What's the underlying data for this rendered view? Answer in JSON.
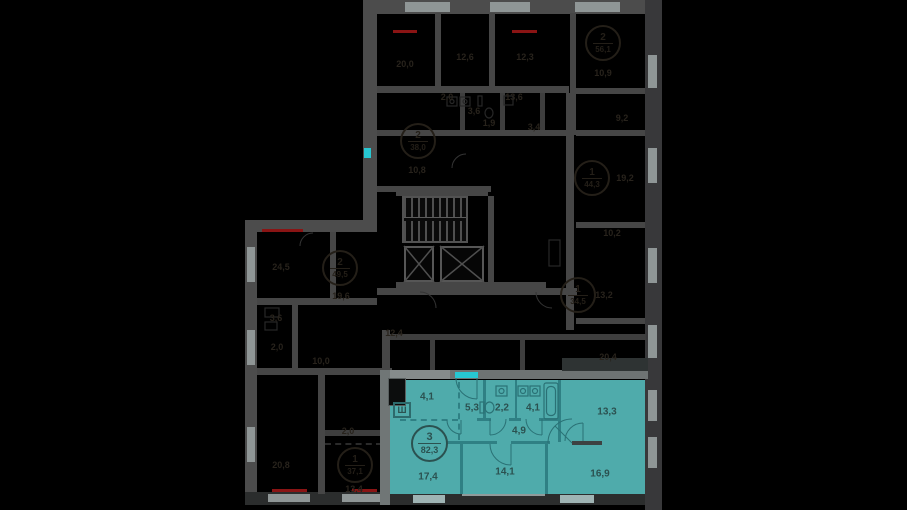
{
  "plan": {
    "highlighted_apartment": {
      "badge": {
        "rooms": "3",
        "area": "82,3"
      },
      "wardrobe_label": "Ш",
      "room_areas": [
        {
          "t": "4,1",
          "x": 427,
          "y": 397
        },
        {
          "t": "5,3",
          "x": 472,
          "y": 408
        },
        {
          "t": "2,2",
          "x": 502,
          "y": 408
        },
        {
          "t": "4,1",
          "x": 533,
          "y": 408
        },
        {
          "t": "13,3",
          "x": 607,
          "y": 412
        },
        {
          "t": "4,9",
          "x": 519,
          "y": 431
        },
        {
          "t": "17,4",
          "x": 428,
          "y": 477
        },
        {
          "t": "14,1",
          "x": 505,
          "y": 472
        },
        {
          "t": "16,9",
          "x": 600,
          "y": 474
        }
      ]
    },
    "dimmed": {
      "area_labels": [
        {
          "t": "20,0",
          "x": 405,
          "y": 64
        },
        {
          "t": "12,6",
          "x": 465,
          "y": 57
        },
        {
          "t": "12,3",
          "x": 525,
          "y": 57
        },
        {
          "t": "10,9",
          "x": 603,
          "y": 73
        },
        {
          "t": "9,2",
          "x": 622,
          "y": 118
        },
        {
          "t": "2,0",
          "x": 447,
          "y": 97
        },
        {
          "t": "13,6",
          "x": 514,
          "y": 97
        },
        {
          "t": "3,6",
          "x": 474,
          "y": 111
        },
        {
          "t": "1,9",
          "x": 489,
          "y": 123
        },
        {
          "t": "3,4",
          "x": 534,
          "y": 127
        },
        {
          "t": "10,8",
          "x": 417,
          "y": 170
        },
        {
          "t": "19,2",
          "x": 625,
          "y": 178
        },
        {
          "t": "10,2",
          "x": 612,
          "y": 233
        },
        {
          "t": "24,5",
          "x": 281,
          "y": 267
        },
        {
          "t": "19,6",
          "x": 341,
          "y": 296
        },
        {
          "t": "3,6",
          "x": 276,
          "y": 318
        },
        {
          "t": "2,0",
          "x": 277,
          "y": 347
        },
        {
          "t": "10,0",
          "x": 321,
          "y": 361
        },
        {
          "t": "12,4",
          "x": 394,
          "y": 333
        },
        {
          "t": "13,2",
          "x": 604,
          "y": 295
        },
        {
          "t": "20,4",
          "x": 608,
          "y": 357
        },
        {
          "t": "20,8",
          "x": 281,
          "y": 465
        },
        {
          "t": "2,0",
          "x": 348,
          "y": 431
        },
        {
          "t": "13,4",
          "x": 354,
          "y": 489
        }
      ],
      "apartment_badges": [
        {
          "rooms": "2",
          "area": "56,1",
          "x": 603,
          "y": 43
        },
        {
          "rooms": "2",
          "area": "38,0",
          "x": 418,
          "y": 141
        },
        {
          "rooms": "1",
          "area": "44,3",
          "x": 592,
          "y": 178
        },
        {
          "rooms": "2",
          "area": "49,5",
          "x": 340,
          "y": 268
        },
        {
          "rooms": "1",
          "area": "34,5",
          "x": 578,
          "y": 295
        },
        {
          "rooms": "1",
          "area": "37,1",
          "x": 355,
          "y": 465
        }
      ]
    },
    "colors": {
      "background": "#000000",
      "highlight_fill": "#4fabab",
      "highlight_wall": "#2f8084",
      "highlight_text": "#2b5150",
      "entry_door_marker": "#27c7d2",
      "wall_gray": "#4c4c4c",
      "window_gray": "#8f9696",
      "radiator_red": "#8a1414",
      "dim_text": "#28231c"
    }
  }
}
